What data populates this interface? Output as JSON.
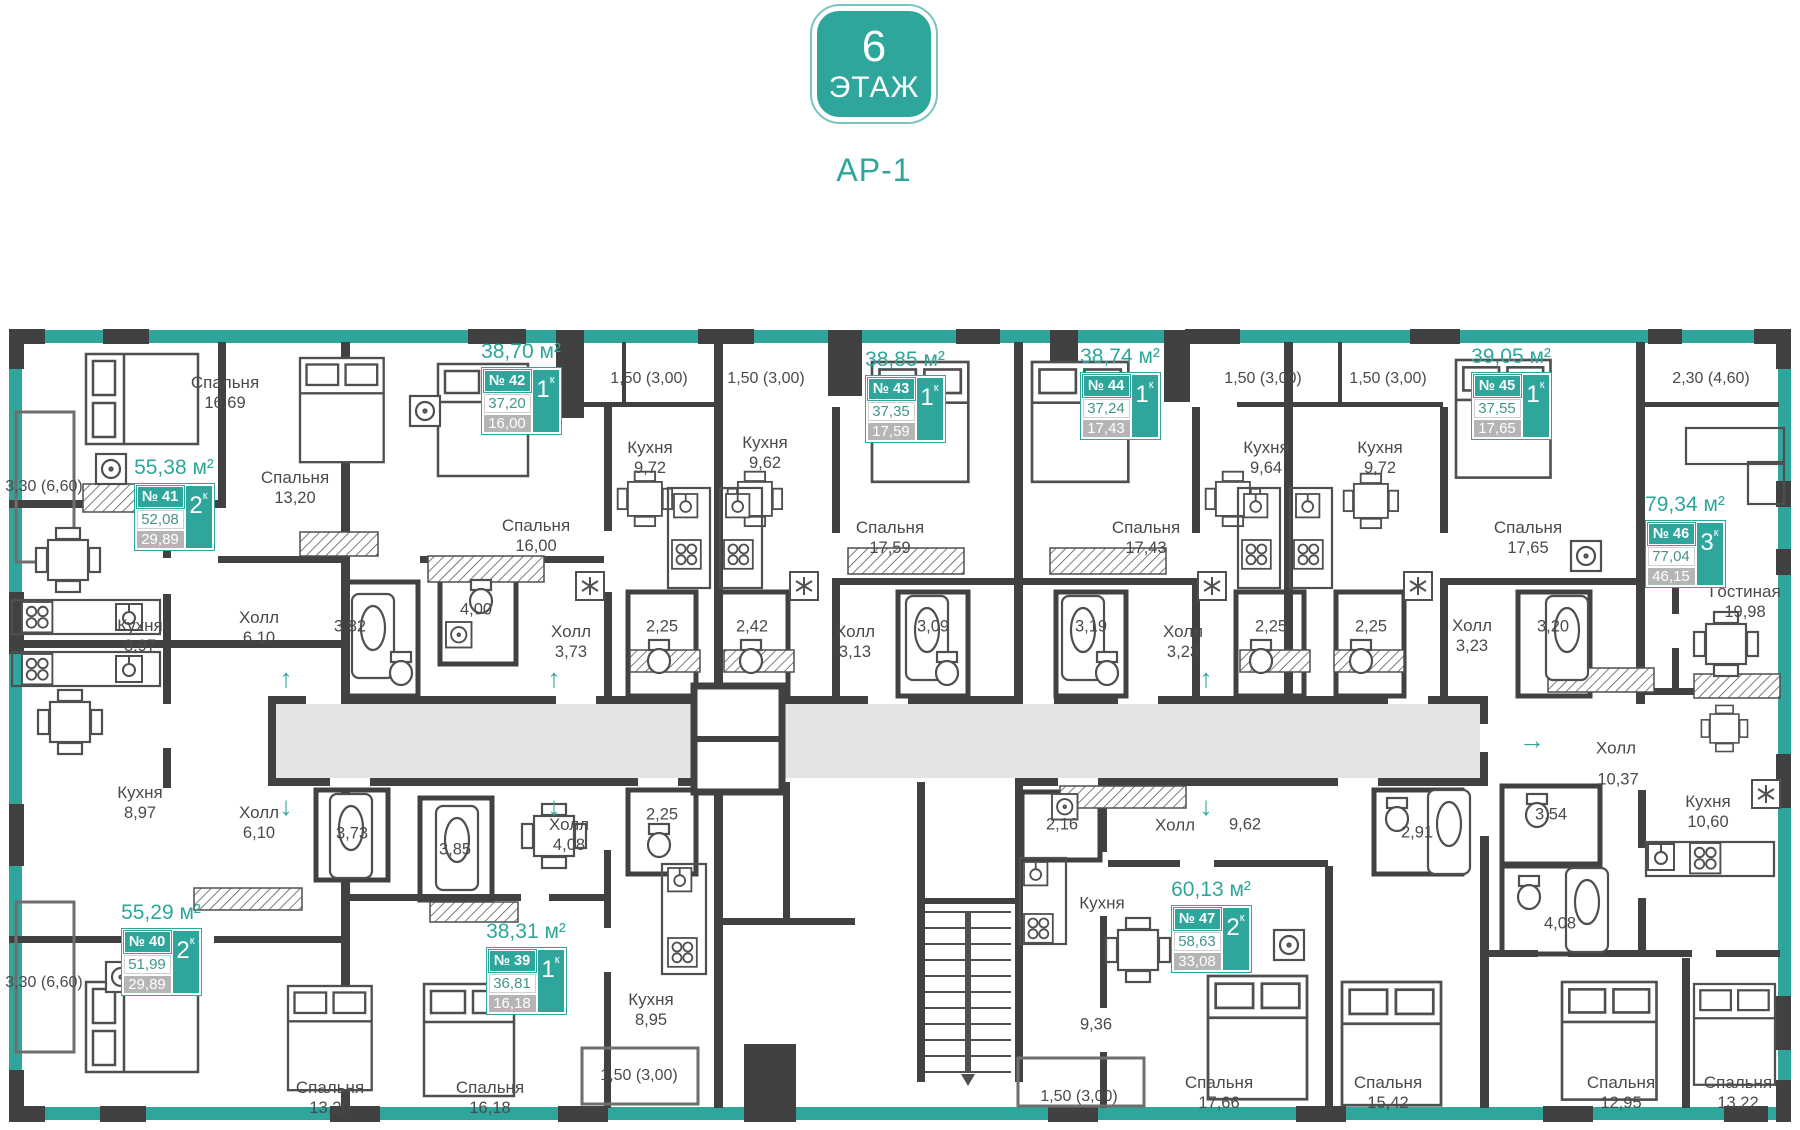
{
  "header": {
    "floor_number": "6",
    "floor_word": "ЭТАЖ",
    "block": "АР-1"
  },
  "apartments": [
    {
      "number": "№ 41",
      "title": "55,38 м²",
      "area1": "52,08",
      "area2": "29,89",
      "rooms": "2",
      "rooms_suffix": "к",
      "cx": 174,
      "top": 456
    },
    {
      "number": "№ 42",
      "title": "38,70 м²",
      "area1": "37,20",
      "area2": "16,00",
      "rooms": "1",
      "rooms_suffix": "к",
      "cx": 521,
      "top": 340
    },
    {
      "number": "№ 43",
      "title": "38,85 м²",
      "area1": "37,35",
      "area2": "17,59",
      "rooms": "1",
      "rooms_suffix": "к",
      "cx": 905,
      "top": 348
    },
    {
      "number": "№ 44",
      "title": "38,74 м²",
      "area1": "37,24",
      "area2": "17,43",
      "rooms": "1",
      "rooms_suffix": "к",
      "cx": 1120,
      "top": 345
    },
    {
      "number": "№ 45",
      "title": "39,05 м²",
      "area1": "37,55",
      "area2": "17,65",
      "rooms": "1",
      "rooms_suffix": "к",
      "cx": 1511,
      "top": 345
    },
    {
      "number": "№ 46",
      "title": "79,34 м²",
      "area1": "77,04",
      "area2": "46,15",
      "rooms": "3",
      "rooms_suffix": "к",
      "cx": 1685,
      "top": 493
    },
    {
      "number": "№ 47",
      "title": "60,13 м²",
      "area1": "58,63",
      "area2": "33,08",
      "rooms": "2",
      "rooms_suffix": "к",
      "cx": 1211,
      "top": 878
    },
    {
      "number": "№ 40",
      "title": "55,29 м²",
      "area1": "51,99",
      "area2": "29,89",
      "rooms": "2",
      "rooms_suffix": "к",
      "cx": 161,
      "top": 901
    },
    {
      "number": "№ 39",
      "title": "38,31 м²",
      "area1": "36,81",
      "area2": "16,18",
      "rooms": "1",
      "rooms_suffix": "к",
      "cx": 526,
      "top": 920
    }
  ],
  "plan": {
    "room_labels": [
      {
        "x": 225,
        "y": 393,
        "n": "Спальня",
        "a": "16,69"
      },
      {
        "x": 295,
        "y": 488,
        "n": "Спальня",
        "a": "13,20"
      },
      {
        "x": 140,
        "y": 636,
        "n": "Кухня",
        "a": "8,97"
      },
      {
        "x": 259,
        "y": 628,
        "n": "Холл",
        "a": "6,10"
      },
      {
        "x": 536,
        "y": 536,
        "n": "Спальня",
        "a": "16,00"
      },
      {
        "x": 650,
        "y": 458,
        "n": "Кухня",
        "a": "9,72"
      },
      {
        "x": 765,
        "y": 453,
        "n": "Кухня",
        "a": "9,62"
      },
      {
        "x": 571,
        "y": 642,
        "n": "Холл",
        "a": "3,73"
      },
      {
        "x": 855,
        "y": 642,
        "n": "Холл",
        "a": "3,13"
      },
      {
        "x": 890,
        "y": 538,
        "n": "Спальня",
        "a": "17,59"
      },
      {
        "x": 1146,
        "y": 538,
        "n": "Спальня",
        "a": "17,43"
      },
      {
        "x": 1266,
        "y": 458,
        "n": "Кухня",
        "a": "9,64"
      },
      {
        "x": 1380,
        "y": 458,
        "n": "Кухня",
        "a": "9,72"
      },
      {
        "x": 1183,
        "y": 642,
        "n": "Холл",
        "a": "3,23"
      },
      {
        "x": 1472,
        "y": 636,
        "n": "Холл",
        "a": "3,23"
      },
      {
        "x": 1528,
        "y": 538,
        "n": "Спальня",
        "a": "17,65"
      },
      {
        "x": 1745,
        "y": 602,
        "n": "Гостиная",
        "a": "19,98"
      },
      {
        "x": 140,
        "y": 803,
        "n": "Кухня",
        "a": "8,97"
      },
      {
        "x": 259,
        "y": 823,
        "n": "Холл",
        "a": "6,10"
      },
      {
        "x": 569,
        "y": 835,
        "n": "Холл",
        "a": "4,08"
      },
      {
        "x": 651,
        "y": 1010,
        "n": "Кухня",
        "a": "8,95"
      },
      {
        "x": 330,
        "y": 1098,
        "n": "Спальня",
        "a": "13,20"
      },
      {
        "x": 490,
        "y": 1098,
        "n": "Спальня",
        "a": "16,18"
      },
      {
        "x": 1708,
        "y": 812,
        "n": "Кухня",
        "a": "10,60"
      },
      {
        "x": 1219,
        "y": 1093,
        "n": "Спальня",
        "a": "17,66"
      },
      {
        "x": 1388,
        "y": 1093,
        "n": "Спальня",
        "a": "15,42"
      },
      {
        "x": 1621,
        "y": 1093,
        "n": "Спальня",
        "a": "12,95"
      },
      {
        "x": 1738,
        "y": 1093,
        "n": "Спальня",
        "a": "13,22"
      }
    ],
    "word_labels": [
      {
        "x": 1175,
        "y": 825,
        "t": "Холл"
      },
      {
        "x": 1102,
        "y": 903,
        "t": "Кухня"
      },
      {
        "x": 1616,
        "y": 748,
        "t": "Холл"
      }
    ],
    "values": [
      {
        "x": 350,
        "y": 627,
        "t": "3,82"
      },
      {
        "x": 476,
        "y": 610,
        "t": "4,00"
      },
      {
        "x": 662,
        "y": 627,
        "t": "2,25"
      },
      {
        "x": 752,
        "y": 627,
        "t": "2,42"
      },
      {
        "x": 933,
        "y": 627,
        "t": "3,09"
      },
      {
        "x": 1091,
        "y": 627,
        "t": "3,19"
      },
      {
        "x": 1271,
        "y": 627,
        "t": "2,25"
      },
      {
        "x": 1371,
        "y": 627,
        "t": "2,25"
      },
      {
        "x": 1553,
        "y": 627,
        "t": "3,20"
      },
      {
        "x": 352,
        "y": 834,
        "t": "3,73"
      },
      {
        "x": 455,
        "y": 850,
        "t": "3,85"
      },
      {
        "x": 662,
        "y": 815,
        "t": "2,25"
      },
      {
        "x": 1062,
        "y": 825,
        "t": "2,16"
      },
      {
        "x": 1417,
        "y": 833,
        "t": "2,91"
      },
      {
        "x": 1551,
        "y": 815,
        "t": "3,54"
      },
      {
        "x": 1560,
        "y": 924,
        "t": "4,08"
      },
      {
        "x": 1096,
        "y": 1025,
        "t": "9,36"
      },
      {
        "x": 1245,
        "y": 825,
        "t": "9,62"
      },
      {
        "x": 1618,
        "y": 780,
        "t": "10,37"
      }
    ],
    "dims": [
      {
        "x": 44,
        "y": 487,
        "t": "3,30 (6,60)"
      },
      {
        "x": 649,
        "y": 379,
        "t": "1,50 (3,00)"
      },
      {
        "x": 766,
        "y": 379,
        "t": "1,50 (3,00)"
      },
      {
        "x": 1263,
        "y": 379,
        "t": "1,50 (3,00)"
      },
      {
        "x": 1388,
        "y": 379,
        "t": "1,50 (3,00)"
      },
      {
        "x": 1711,
        "y": 379,
        "t": "2,30 (4,60)"
      },
      {
        "x": 44,
        "y": 983,
        "t": "3,30 (6,60)"
      },
      {
        "x": 639,
        "y": 1076,
        "t": "1,50 (3,00)"
      },
      {
        "x": 1079,
        "y": 1097,
        "t": "1,50 (3,00)"
      }
    ],
    "arrows": [
      {
        "x": 286,
        "y": 678,
        "g": "↑"
      },
      {
        "x": 554,
        "y": 678,
        "g": "↑"
      },
      {
        "x": 1206,
        "y": 678,
        "g": "↑"
      },
      {
        "x": 286,
        "y": 806,
        "g": "↓"
      },
      {
        "x": 554,
        "y": 806,
        "g": "↓"
      },
      {
        "x": 1206,
        "y": 806,
        "g": "↓"
      },
      {
        "x": 1532,
        "y": 740,
        "g": "→"
      }
    ],
    "colors": {
      "teal": "#2ea69c",
      "wall": "#414141",
      "corridor": "#e4e4e4",
      "chip_gray": "#b5b5b5"
    }
  }
}
